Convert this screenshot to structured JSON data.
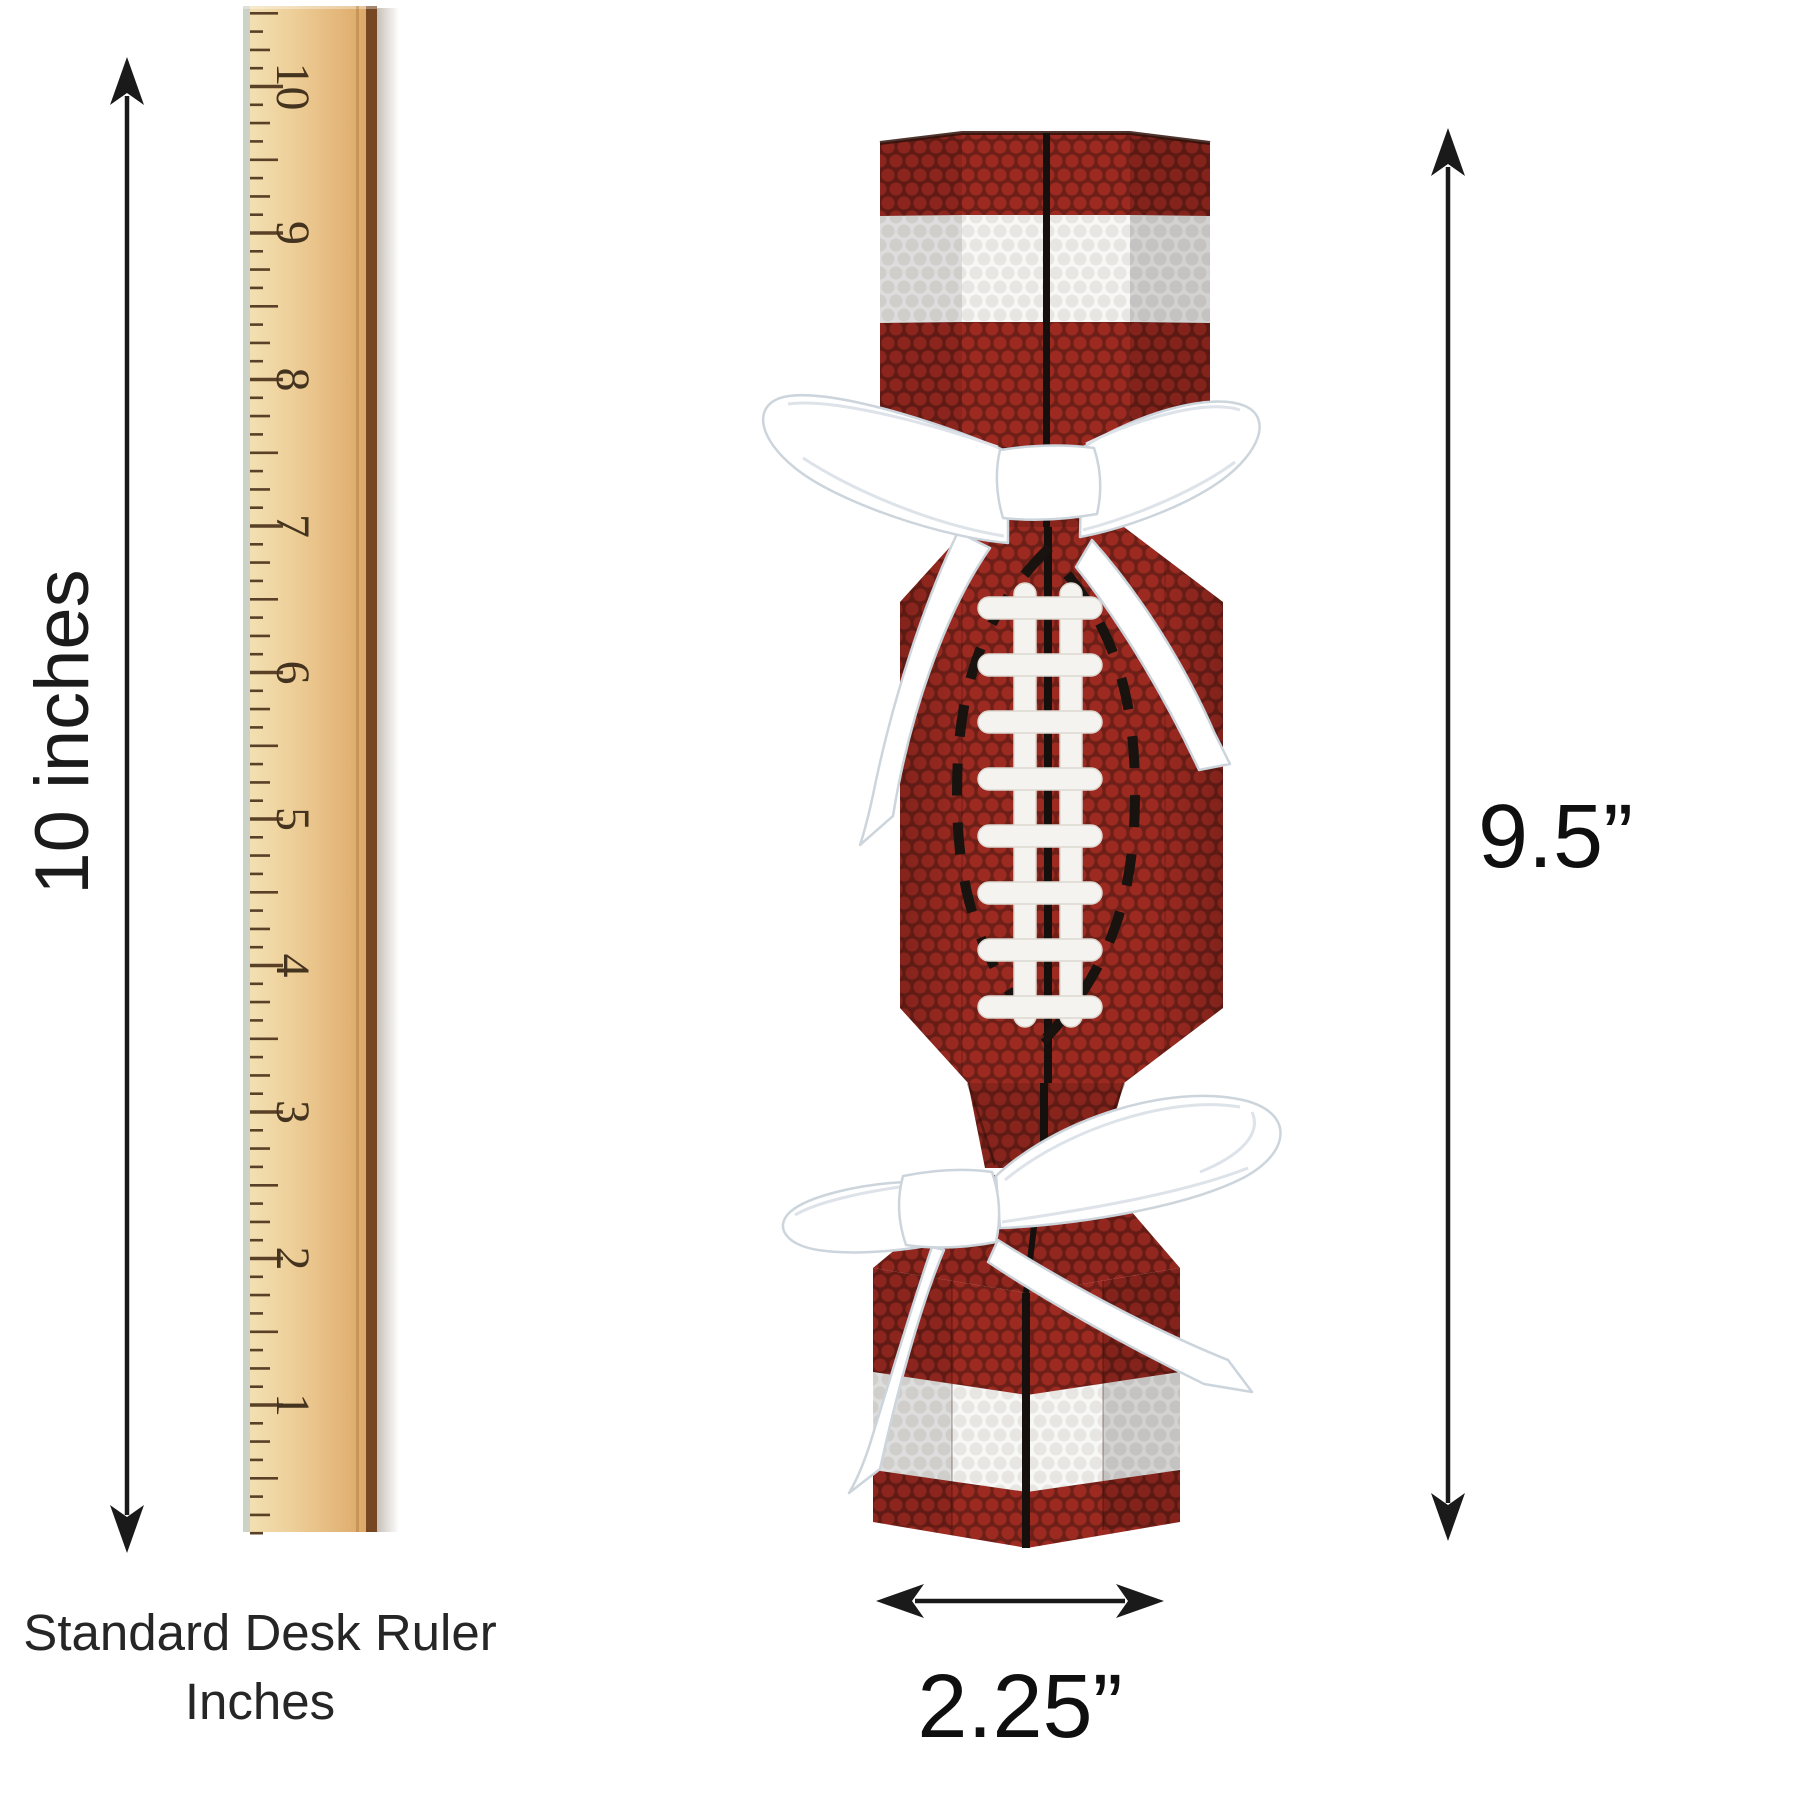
{
  "labels": {
    "ruler_length": "10 inches",
    "caption_line1": "Standard Desk Ruler",
    "caption_line2": "Inches",
    "product_height": "9.5”",
    "product_width": "2.25”"
  },
  "ruler": {
    "numbers": [
      "10",
      "9",
      "8",
      "7",
      "6",
      "5",
      "4",
      "3",
      "2",
      "1"
    ]
  },
  "product": {
    "name": "football shaped party favor cracker box",
    "pattern": "football leather dots with white stripe, black seam, white laces, dashed lace outline",
    "ribbon": "white satin bow tied at both ends"
  },
  "colors": {
    "leather_base": "#6e1f17",
    "leather_dot": "#9c2a21",
    "stripe_base": "#f7f7f6",
    "stripe_dot": "#e8e6e3",
    "seam": "#15100d",
    "lace": "#f5f3f0",
    "ribbon": "#ffffff",
    "ribbon_edge": "#ccd4dc",
    "wood_light": "#f3e2b6",
    "wood_dark": "#d9a360",
    "tick": "#5a4027",
    "arrow": "#1a1a1a"
  }
}
